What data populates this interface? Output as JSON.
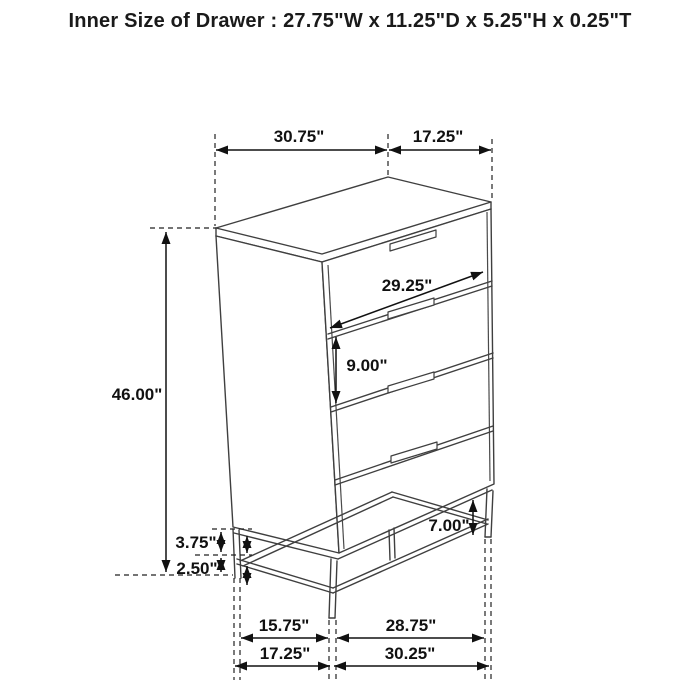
{
  "title": "Inner Size of Drawer : 27.75\"W x 11.25\"D x 5.25\"H x 0.25\"T",
  "drawing": {
    "subject": "four-drawer-chest-with-metal-base",
    "style": "black-line-technical-illustration-on-white"
  },
  "dimensions": {
    "top_left_span": "30.75\"",
    "top_right_span": "17.25\"",
    "drawer_front_width": "29.25\"",
    "drawer_front_height": "9.00\"",
    "overall_height": "46.00\"",
    "leg_height": "7.00\"",
    "base_upper_gap": "3.75\"",
    "base_lower_gap": "2.50\"",
    "bottom_left_inner_span": "15.75\"",
    "bottom_right_inner_span": "28.75\"",
    "bottom_left_outer_span": "17.25\"",
    "bottom_right_outer_span": "30.25\""
  },
  "colors": {
    "background": "#ffffff",
    "furniture_stroke": "#3f3f3f",
    "dimension_stroke": "#111111",
    "text": "#111111"
  }
}
